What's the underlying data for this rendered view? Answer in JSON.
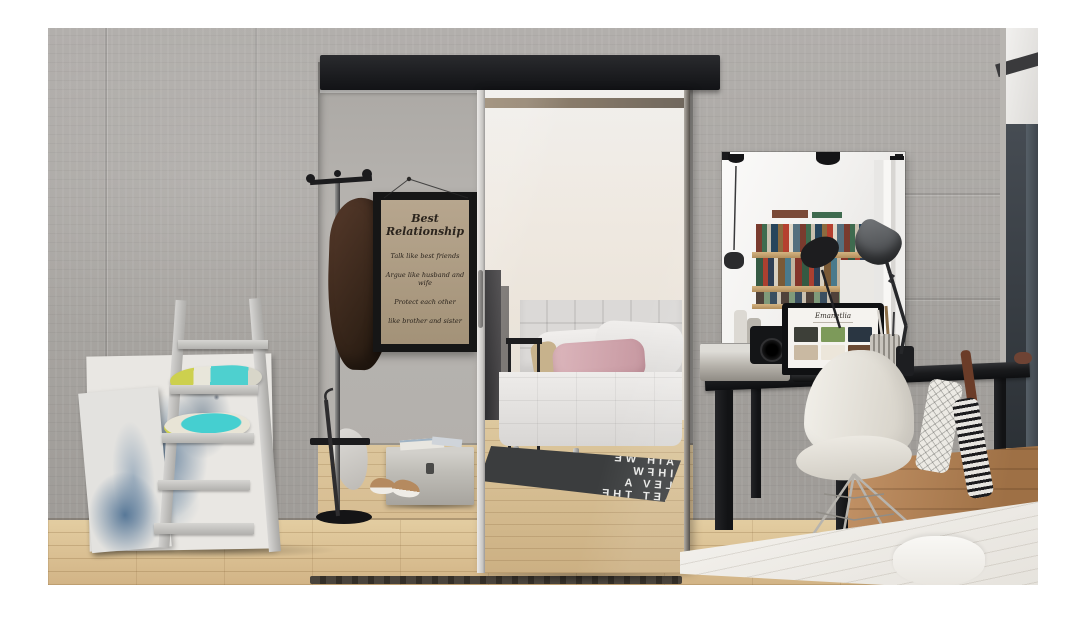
{
  "scene_type": "interior-photograph",
  "description": "Modern interior: sliding frameless mirror door on a black top rail set in a concrete wall, reflecting a bedroom with tufted white bed and typographic rug; alcove with coat stand, quote poster and storage chest; right side black desk with laptop, camera and task lamp under a wall mirror reflecting a bookshelf; white shell chair, wooden crate, leaning ladder shelf with teal pillows and abstract canvases; light oak floor; white bed corner in foreground",
  "poster": {
    "title": "Best Relationship",
    "lines": [
      "Talk like best friends",
      "Argue like husband and wife",
      "Protect each other",
      "like brother and sister"
    ]
  },
  "laptop_screen": {
    "brand": "Emanetlia",
    "thumb_styles": [
      "background:#3d3f38",
      "background:#7d9a5a",
      "background:#2a3642",
      "background:#c9b9a2",
      "background:#ece6da",
      "background:#6b4a33"
    ]
  },
  "mirror_rug": {
    "rows": [
      "AIH WE",
      "IHFW",
      "LEV A",
      "LET THE"
    ]
  },
  "colors": {
    "wall_concrete": "#a7a4a0",
    "alcove_wall": "#b3b0ac",
    "rail_black": "#1f2023",
    "floor_wood": "#d8bf94",
    "desk_black": "#1b1c1e",
    "chair_white": "#edeae4",
    "pillow_teal": "#4ed0cf",
    "pillow_yellow": "#cdd04e",
    "pink_pillow": "#d8aeb6",
    "navy_wall": "#3a4048",
    "crate_wood": "#b58756",
    "rug_dark": "#3a3c3d",
    "coat_brown": "#45301f",
    "poster_paper": "#b3a289"
  }
}
